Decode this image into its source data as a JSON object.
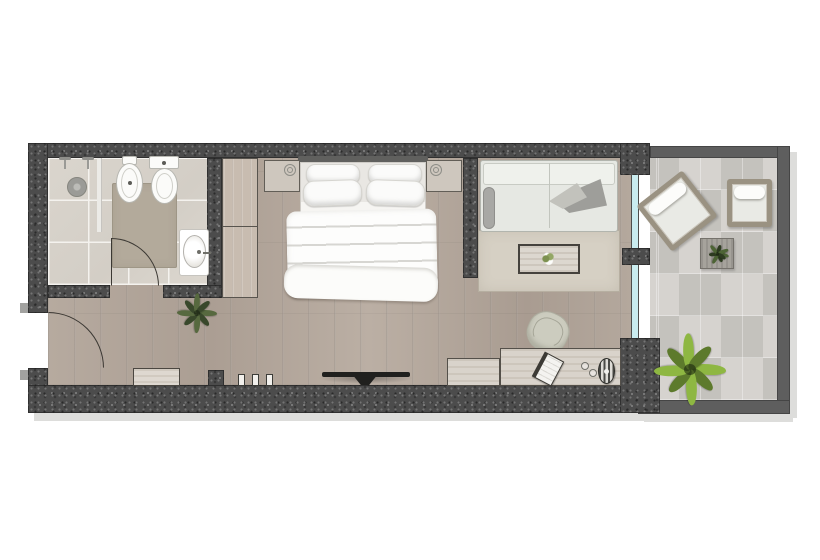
{
  "document": {
    "type": "floor-plan",
    "description": "Top-down architectural floor plan of a hotel guest room: bathroom at left, entry hall, bedroom with double bed and wardrobe, living area with sofa and desk, glass wall opening onto a balcony terrace at right",
    "visible_text": []
  },
  "palette": {
    "background": "#ffffff",
    "interior_wall": "#4c4c4c",
    "balcony_wall": "#5e5e5e",
    "wood_floor": "#b2a69b",
    "bathroom_tile": "#d8d3cb",
    "balcony_concrete": "#cfccc7",
    "area_rug": "#d6d0c4",
    "bath_mat": "#b3aa9b",
    "glass": "#c9ecef",
    "linen_white": "#fbfbf9",
    "sofa_fabric": "#e6e8e3",
    "lounge_frame": "#9a9282",
    "bright_plant": "#8eb742",
    "dark_plant": "#57693f",
    "tv_black": "#20201e"
  },
  "rooms": [
    {
      "id": "bathroom",
      "features": [
        "shower-heads",
        "shower-drain",
        "glass-divider",
        "bidet",
        "toilet",
        "vanity-sink",
        "bath-mat",
        "door-swing"
      ]
    },
    {
      "id": "entry-hall",
      "features": [
        "entrance-door-swing",
        "luggage-bench",
        "potted-plant",
        "wall-posts"
      ]
    },
    {
      "id": "bedroom",
      "features": [
        "wardrobe",
        "double-bed",
        "headboard",
        "four-pillows",
        "duvet",
        "nightstand-left",
        "nightstand-right",
        "reading-lamps",
        "wall-mounted-tv"
      ]
    },
    {
      "id": "living-area",
      "features": [
        "sofa",
        "throw-blanket",
        "bolster-pillow",
        "area-rug",
        "coffee-table-with-flowers",
        "desk",
        "low-cabinet",
        "desk-chair",
        "book",
        "desk-lamp",
        "glasses"
      ]
    },
    {
      "id": "balcony",
      "features": [
        "glass-sliding-wall",
        "angled-lounge-chair",
        "straight-lounge-chair",
        "side-table-with-plant",
        "large-potted-plant"
      ]
    }
  ]
}
